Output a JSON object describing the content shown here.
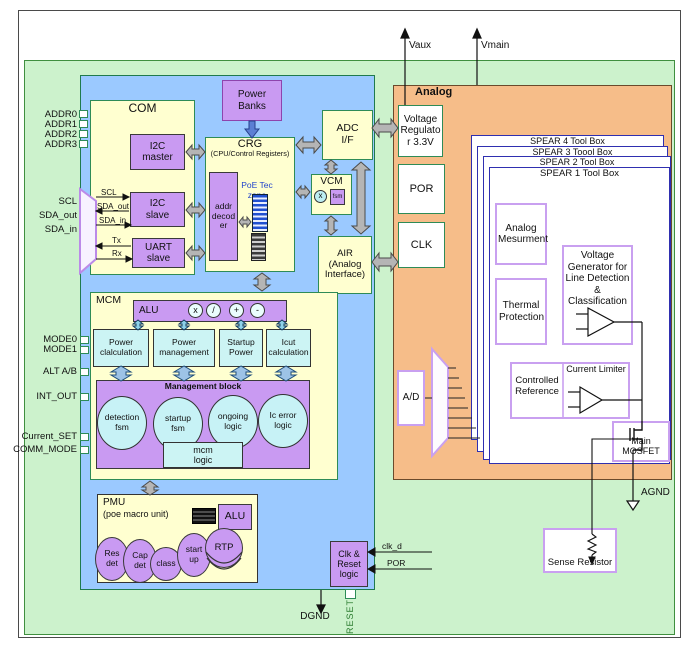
{
  "diagram": {
    "pins_left": [
      "ADDR0",
      "ADDR1",
      "ADDR2",
      "ADDR3"
    ],
    "pins_serial": [
      "SCL",
      "SDA_out",
      "SDA_in"
    ],
    "pins_mode": [
      "MODE0",
      "MODE1",
      "ALT A/B",
      "INT_OUT",
      "Current_SET",
      "COMM_MODE"
    ],
    "pin_reset": "RESET",
    "grounds": {
      "dgnd": "DGND",
      "agnd": "AGND"
    },
    "supplies": {
      "vaux": "Vaux",
      "vmain": "Vmain"
    },
    "com": {
      "title": "COM",
      "i2c_master": "I2C master",
      "i2c_slave": "I2C slave",
      "uart_slave": "UART slave",
      "sig_scl": "SCL",
      "sig_sda_out": "SDA_out",
      "sig_sda_in": "SDA_in",
      "sig_tx": "Tx",
      "sig_rx": "Rx"
    },
    "power_banks": "Power Banks",
    "crg": {
      "title": "CRG",
      "subtitle": "(CPU/Control Registers)",
      "addr_decoder": "addr decoder",
      "poe_tec": "PoE Tec zone"
    },
    "adc_if": "ADC I/F",
    "vcm": {
      "title": "VCM",
      "mult": "x",
      "fsm": "fsm"
    },
    "air": "AIR (Analog Interface)",
    "mcm": {
      "title": "MCM",
      "alu": "ALU",
      "ops": [
        "x",
        "/",
        "+",
        "-"
      ],
      "calc_boxes": [
        "Power clalculation",
        "Power management",
        "Startup Power",
        "Icut calculation"
      ],
      "mgmt_title": "Management block",
      "fsm_circles": [
        "detection fsm",
        "startup fsm",
        "ongoing logic",
        "Ic error logic"
      ],
      "mcm_logic": "mcm logic"
    },
    "pmu": {
      "title": "PMU",
      "subtitle": "(poe macro unit)",
      "alu": "ALU",
      "units": [
        "Res det",
        "Cap det",
        "class",
        "start up",
        "RTP"
      ]
    },
    "clk_reset": {
      "label": "Clk & Reset logic",
      "sig_clk_d": "clk_d",
      "sig_por": "POR"
    },
    "analog": {
      "title": "Analog",
      "vreg": "Voltage Regulator 3.3V",
      "por": "POR",
      "clk": "CLK",
      "spear": [
        "SPEAR 4 Tool Box",
        "SPEAR 3 Toool Box",
        "SPEAR 2 Tool Box",
        "SPEAR 1 Tool Box"
      ],
      "analog_measurement": "Analog Mesurment",
      "thermal": "Thermal Protection",
      "vgen": "Voltage Generator for Line Detection & Classification",
      "controlled_ref": "Controlled Reference",
      "current_limiter": "Current Limiter",
      "main_mosfet": "Main MOSFET",
      "ad": "A/D",
      "sense_resistor": "Sense Resistor"
    },
    "colors": {
      "digital_bg": "#9bc9ff",
      "block_fill": "#ffffd0",
      "purple_fill": "#c99af2",
      "cyan_fill": "#ccf4f4",
      "analog_bg": "#f6bd89",
      "chip_bg": "#ccf2cc",
      "arrow_gray": "#b5b5b5",
      "green_border": "#2e8b57",
      "spear_border": "#2f2fb0",
      "inner_border": "#c9a0f0",
      "poe_text": "#2244cc",
      "reset_text": "#2e7d32"
    }
  }
}
